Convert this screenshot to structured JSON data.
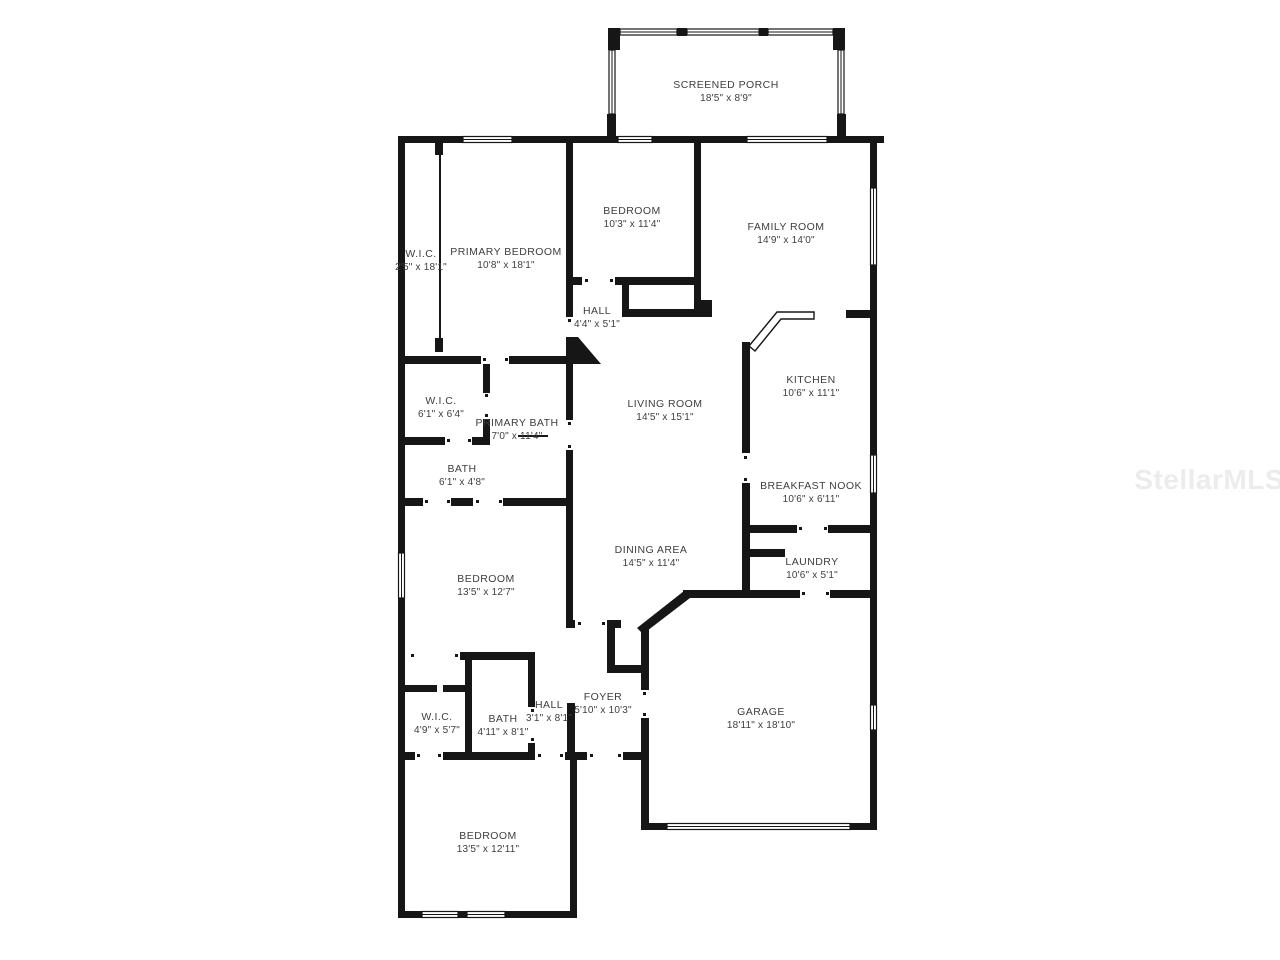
{
  "watermark": "StellarMLS",
  "rooms": {
    "screened_porch": {
      "name": "SCREENED PORCH",
      "dims": "18'5\" x 8'9\""
    },
    "wic_primary": {
      "name": "W.I.C.",
      "dims": "2'5\" x 18'1\""
    },
    "primary_bedroom": {
      "name": "PRIMARY BEDROOM",
      "dims": "10'8\" x 18'1\""
    },
    "bedroom_top": {
      "name": "BEDROOM",
      "dims": "10'3\" x 11'4\""
    },
    "family_room": {
      "name": "FAMILY ROOM",
      "dims": "14'9\" x 14'0\""
    },
    "hall_upper": {
      "name": "HALL",
      "dims": "4'4\" x 5'1\""
    },
    "kitchen": {
      "name": "KITCHEN",
      "dims": "10'6\" x 11'1\""
    },
    "living_room": {
      "name": "LIVING ROOM",
      "dims": "14'5\" x 15'1\""
    },
    "wic_ensuite": {
      "name": "W.I.C.",
      "dims": "6'1\" x 6'4\""
    },
    "primary_bath": {
      "name": "PRIMARY BATH",
      "dims": "7'0\" x 11'4\""
    },
    "bath_ensuite": {
      "name": "BATH",
      "dims": "6'1\" x 4'8\""
    },
    "breakfast_nook": {
      "name": "BREAKFAST NOOK",
      "dims": "10'6\" x 6'11\""
    },
    "dining_area": {
      "name": "DINING AREA",
      "dims": "14'5\" x 11'4\""
    },
    "laundry": {
      "name": "LAUNDRY",
      "dims": "10'6\" x 5'1\""
    },
    "bedroom_middle": {
      "name": "BEDROOM",
      "dims": "13'5\" x 12'7\""
    },
    "foyer": {
      "name": "FOYER",
      "dims": "5'10\" x 10'3\""
    },
    "hall_lower": {
      "name": "HALL",
      "dims": "3'1\" x 8'1\""
    },
    "bath_main": {
      "name": "BATH",
      "dims": "4'11\" x 8'1\""
    },
    "wic_bottom": {
      "name": "W.I.C.",
      "dims": "4'9\" x 5'7\""
    },
    "garage": {
      "name": "GARAGE",
      "dims": "18'11\" x 18'10\""
    },
    "bedroom_bottom": {
      "name": "BEDROOM",
      "dims": "13'5\" x 12'11\""
    }
  }
}
